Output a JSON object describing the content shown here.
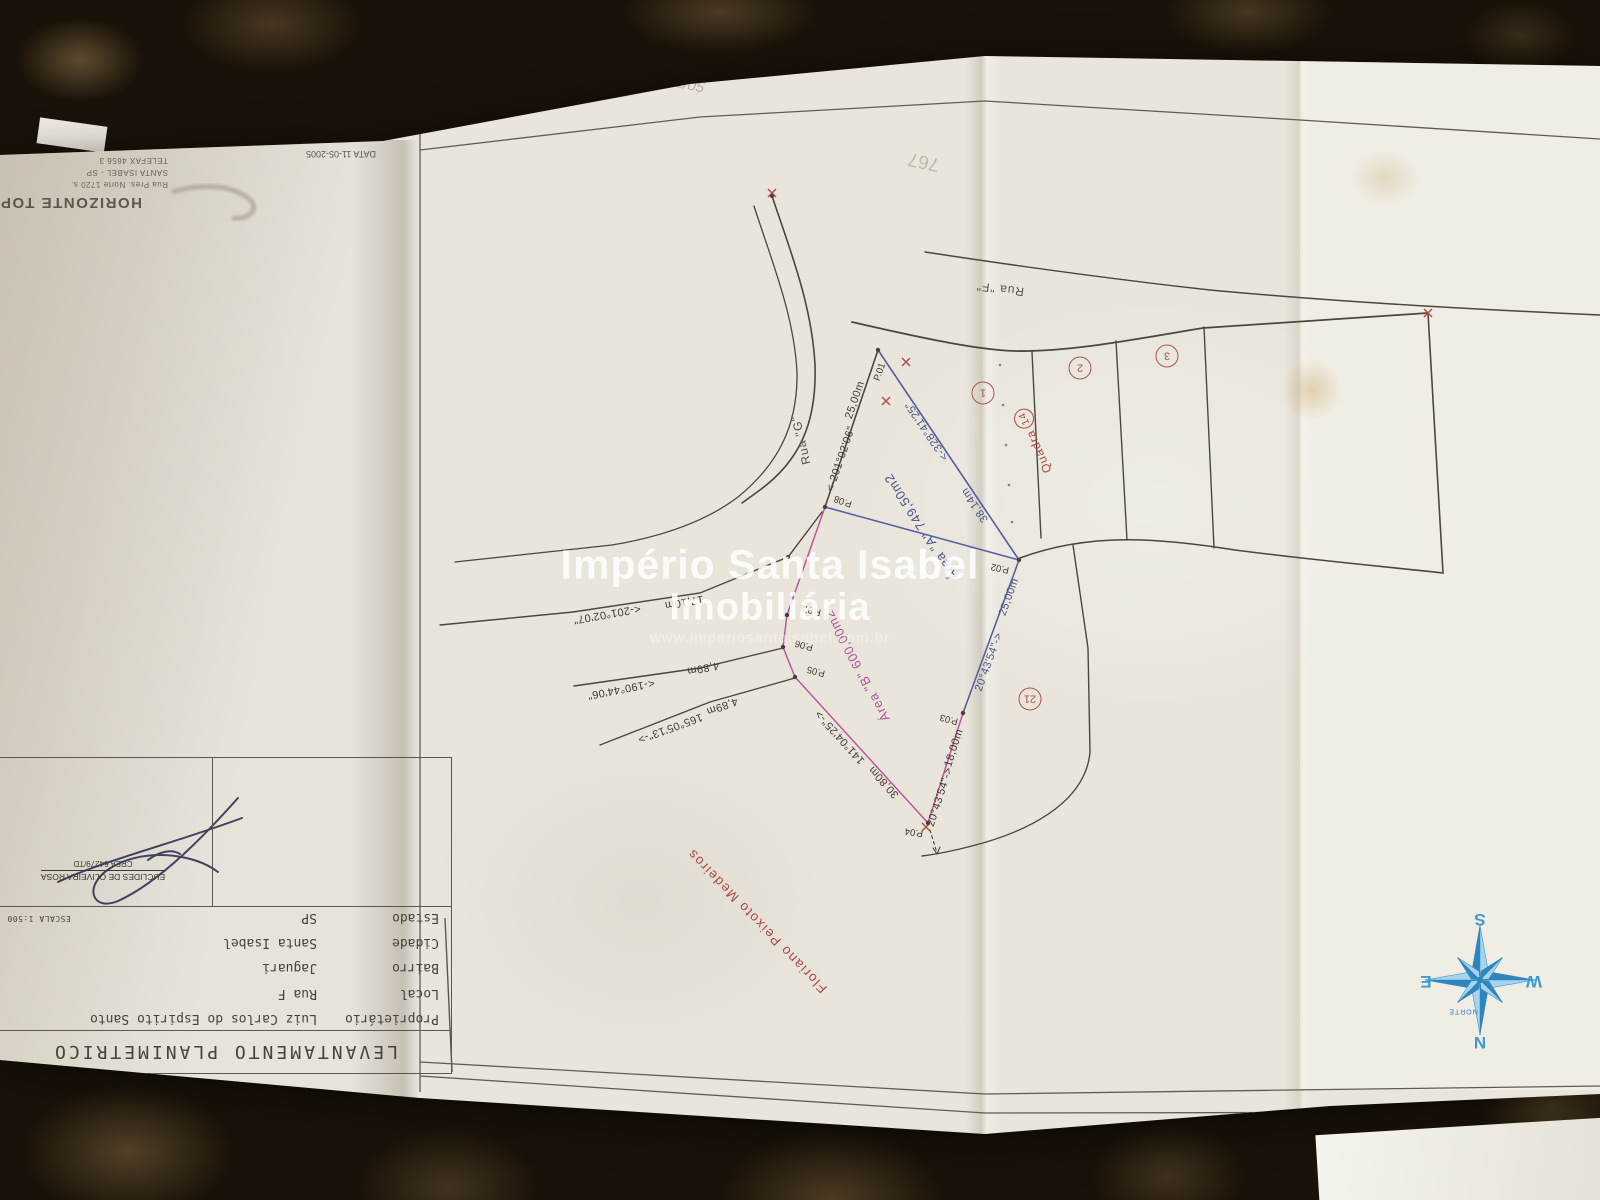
{
  "photo": {
    "stamp": {
      "company": "HORIZONTE TOPO",
      "address": "Rua Pres. Norte 1720 s.",
      "city": "SANTA ISABEL - SP",
      "phone": "TELEFAX 4656 3",
      "date": "DATA 11-05-2005"
    },
    "pencil_note_top": "11/05",
    "pencil_note_right": "767"
  },
  "title_block": {
    "title": "LEVANTAMENTO PLANIMETRICO",
    "rows": [
      {
        "label": "Proprietário",
        "value": "Luiz Carlos do Espirito Santo"
      },
      {
        "label": "Local",
        "value": "Rua F"
      },
      {
        "label": "Bairro",
        "value": "Jaguari"
      },
      {
        "label": "Cidade",
        "value": "Santa Isabel"
      },
      {
        "label": "Estado",
        "value": "SP"
      }
    ],
    "escala": "ESCALA 1:500",
    "signature": {
      "name": "EUCLIDES DE OLIVEIRA ROSA",
      "crea": "CREA 64279/TD"
    }
  },
  "watermark": {
    "line1": "Império Santa Isabel",
    "line2": "Imobiliária",
    "url": "www.imperiosantaisabel.com.br"
  },
  "plan": {
    "rua_f": "Rua \"F\"",
    "rua_g": "Rua \"G\"",
    "quadra_label": "Quadra",
    "quadra_number": "14",
    "lot_numbers": [
      "1",
      "2",
      "3",
      "21"
    ],
    "area_a": "Área \"A\" 749,50m2",
    "area_b": "Área \"B\" 600,00m2",
    "neighbor": "Floriano Peixoto Medeiros",
    "points": {
      "p01": "P.01",
      "p02": "P.02",
      "p03": "P.03",
      "p04": "P.04",
      "p05": "P.05",
      "p06": "P.06",
      "p07": "P.07",
      "p08": "P.08"
    },
    "dims": {
      "d_2500_a": "25,00m",
      "d_2500_b": "25,00m",
      "d_3814": "38,14m",
      "d_1800": "18,00m",
      "d_3080": "30,80m",
      "d_1710": "17,10m",
      "d_489_a": "4,89m",
      "d_489_b": "4,89m"
    },
    "bearings": {
      "b_328": "<-328°41'25\"",
      "b_201_06": "<-201°02'06\"",
      "b_201_07": "<-201°02'07\"",
      "b_190": "<-190°44'06\"",
      "b_165": "165°05'13\"->",
      "b_141": "141°04'25\"->",
      "b_2043_a": "20°43'54\"->",
      "b_2043_b": "20°43'54\"->"
    }
  },
  "compass": {
    "n": "N",
    "s": "S",
    "e": "E",
    "w": "W",
    "norte": "NORTE"
  }
}
